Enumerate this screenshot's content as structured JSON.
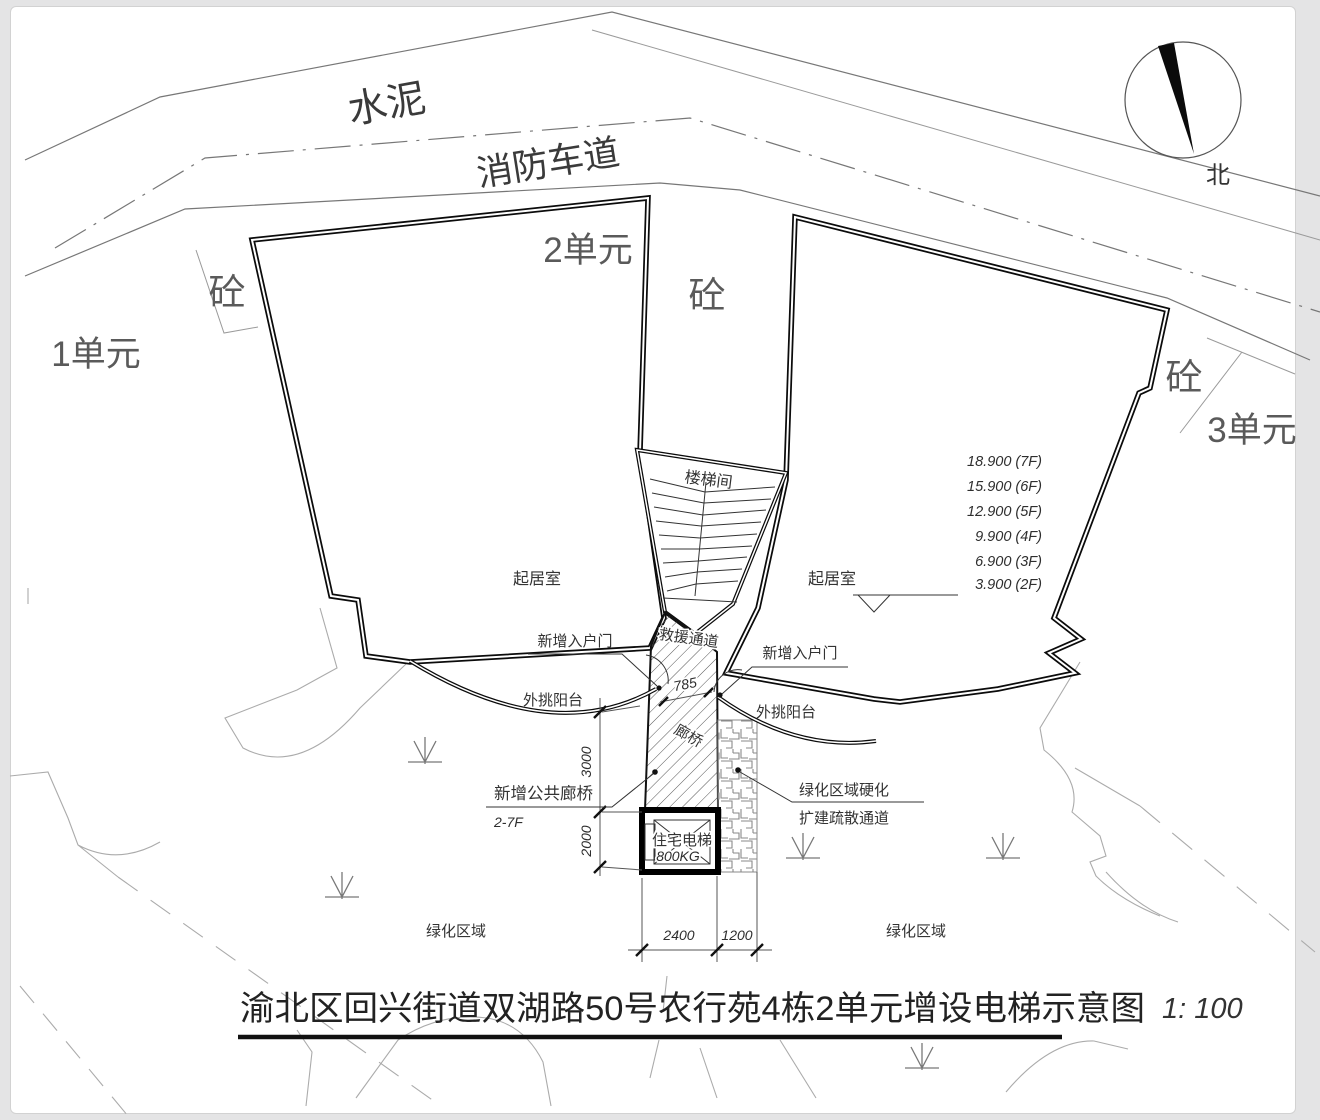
{
  "title": {
    "text": "渝北区回兴街道双湖路50号农行苑4栋2单元增设电梯示意图",
    "scale": "1: 100"
  },
  "compass": {
    "label": "北"
  },
  "roads": {
    "surface_label": "水泥",
    "fire_lane_label": "消防车道"
  },
  "units": {
    "u1": "1单元",
    "u2": "2单元",
    "u3": "3单元"
  },
  "materials": {
    "concrete1": "砼",
    "concrete2": "砼",
    "concrete3": "砼"
  },
  "rooms": {
    "stairwell": "楼梯间",
    "living_left": "起居室",
    "living_right": "起居室"
  },
  "levels": [
    "18.900 (7F)",
    "15.900 (6F)",
    "12.900 (5F)",
    "9.900 (4F)",
    "6.900 (3F)",
    "3.900 (2F)"
  ],
  "callouts": {
    "door_left": "新增入户门",
    "door_right": "新增入户门",
    "rescue": "救援通道",
    "bridge": "廊桥",
    "balcony_left": "外挑阳台",
    "balcony_right": "外挑阳台",
    "public_bridge": "新增公共廊桥",
    "floors": "2-7F",
    "elevator_name": "住宅电梯",
    "elevator_load": "800KG",
    "green_harden1": "绿化区域硬化",
    "green_harden2": "扩建疏散通道",
    "green_left": "绿化区域",
    "green_right": "绿化区域"
  },
  "dims": {
    "shaft_w": "2400",
    "paving_w": "1200",
    "bridge_l": "3000",
    "shaft_d": "2000",
    "gap": "785"
  },
  "colors": {
    "paper": "#ffffff",
    "background": "#e4e4e5",
    "heavy_line": "#0b0b0b",
    "light_line": "#9a9a9a"
  }
}
